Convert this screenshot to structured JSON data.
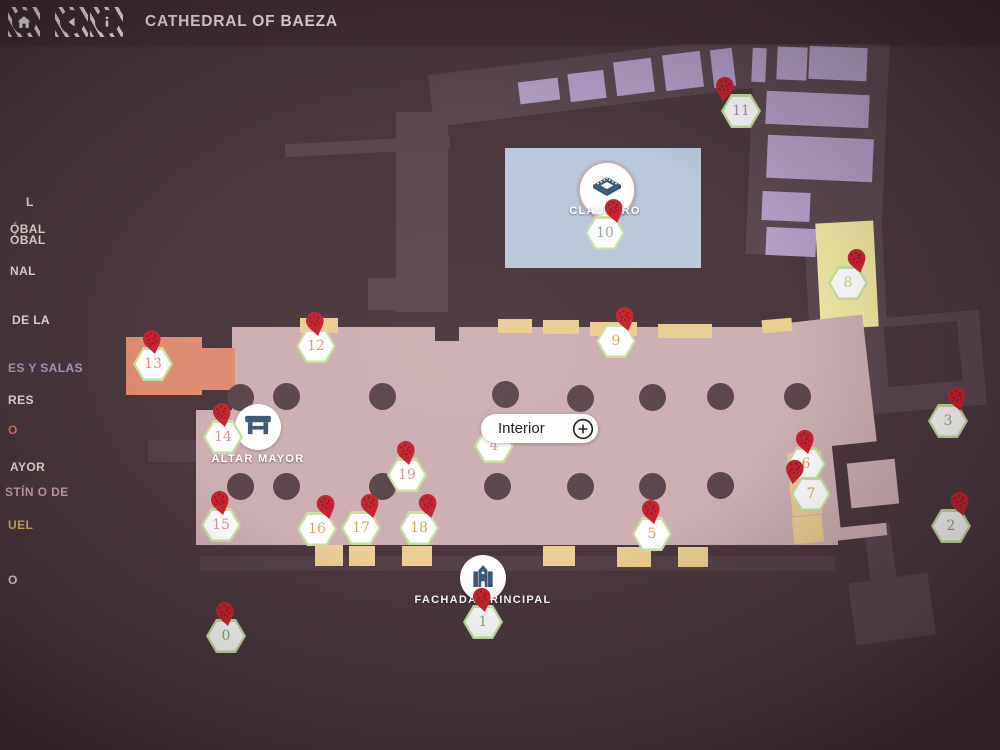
{
  "header": {
    "title": "CATHEDRAL OF BAEZA",
    "home_icon": "home-icon",
    "back_icon": "back-icon",
    "info_icon": "info-icon"
  },
  "sidebar": {
    "items": [
      {
        "label": "L",
        "color": "cream"
      },
      {
        "label": "ÓBAL",
        "color": "cream"
      },
      {
        "label": "ÓBAL",
        "color": "cream"
      },
      {
        "label": "NAL",
        "color": "cream"
      },
      {
        "label": "DE LA",
        "color": "cream"
      },
      {
        "label": "ES Y SALAS",
        "color": "purple"
      },
      {
        "label": "RES",
        "color": "cream"
      },
      {
        "label": "O",
        "color": "red"
      },
      {
        "label": "AYOR",
        "color": "cream"
      },
      {
        "label": "STÍN O DE",
        "color": "pink"
      },
      {
        "label": "UEL",
        "color": "gold"
      },
      {
        "label": "O",
        "color": "cream"
      }
    ]
  },
  "map": {
    "labels": {
      "claustro": "CLAUSTRO",
      "altar_mayor": "ALTAR MAYOR",
      "fachada_principal": "FACHADA PRINCIPAL",
      "interior_button": "Interior"
    },
    "colors": {
      "bg": "#4a383e",
      "wall": "#5b4850",
      "wall_soft": "#544149",
      "nave": "#cdafb3",
      "salmon": "#de8b72",
      "tan": "#eccd92",
      "purple": "#b3a0c8",
      "blue": "#b9c8da",
      "yellow": "#f0e9a2",
      "pillar": "#5b464d",
      "hex_border": "#c6e0a3",
      "pin": "#c5242f",
      "pin_dots": "#8c1a24",
      "icon_blue": "#3c5a74",
      "num_green": "#8fae6e",
      "num_tan": "#d6a65c",
      "num_yellow": "#d9ce7d",
      "num_pink": "#c79aa0",
      "num_salmon": "#d88a70",
      "num_purple": "#a78fc5",
      "num_bluegray": "#93a3ac",
      "side_cream": "#eee7db",
      "side_purple": "#b3a0c8",
      "side_red": "#e07a66",
      "side_pink": "#cfa9ae",
      "side_gold": "#d9b96b",
      "header_bg": "#412e34"
    },
    "markers": [
      {
        "n": "0",
        "x": 226,
        "y": 636,
        "color": "green",
        "pin": "top"
      },
      {
        "n": "1",
        "x": 483,
        "y": 622,
        "color": "green",
        "pin": "top"
      },
      {
        "n": "2",
        "x": 951,
        "y": 526,
        "color": "green",
        "pin": "tr"
      },
      {
        "n": "3",
        "x": 948,
        "y": 421,
        "color": "green",
        "pin": "tr"
      },
      {
        "n": "4",
        "x": 494,
        "y": 446,
        "color": "pink",
        "pin": "none"
      },
      {
        "n": "5",
        "x": 652,
        "y": 534,
        "color": "tan",
        "pin": "top"
      },
      {
        "n": "6",
        "x": 806,
        "y": 464,
        "color": "tan",
        "pin": "top"
      },
      {
        "n": "7",
        "x": 811,
        "y": 494,
        "color": "tan",
        "pin": "tl"
      },
      {
        "n": "8",
        "x": 848,
        "y": 283,
        "color": "yellow",
        "pin": "tr"
      },
      {
        "n": "9",
        "x": 616,
        "y": 341,
        "color": "tan",
        "pin": "tr"
      },
      {
        "n": "10",
        "x": 605,
        "y": 233,
        "color": "bluegray",
        "pin": "tr"
      },
      {
        "n": "11",
        "x": 741,
        "y": 111,
        "color": "purple",
        "pin": "tl"
      },
      {
        "n": "12",
        "x": 316,
        "y": 346,
        "color": "tan",
        "pin": "top"
      },
      {
        "n": "13",
        "x": 153,
        "y": 364,
        "color": "salmon",
        "pin": "top"
      },
      {
        "n": "14",
        "x": 223,
        "y": 437,
        "color": "pink",
        "pin": "top"
      },
      {
        "n": "15",
        "x": 221,
        "y": 525,
        "color": "pink",
        "pin": "top"
      },
      {
        "n": "16",
        "x": 317,
        "y": 529,
        "color": "tan",
        "pin": "tr"
      },
      {
        "n": "17",
        "x": 361,
        "y": 528,
        "color": "tan",
        "pin": "tr"
      },
      {
        "n": "18",
        "x": 419,
        "y": 528,
        "color": "tan",
        "pin": "tr"
      },
      {
        "n": "19",
        "x": 407,
        "y": 475,
        "color": "pink",
        "pin": "top"
      }
    ]
  }
}
